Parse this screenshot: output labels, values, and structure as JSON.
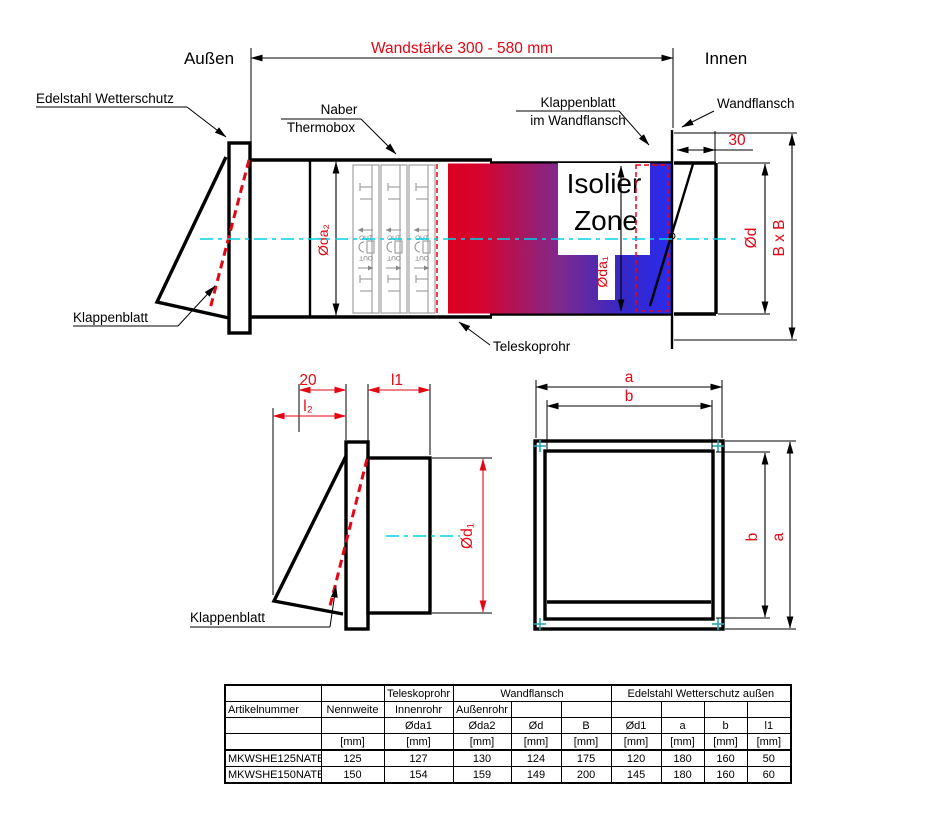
{
  "colors": {
    "red": "#e30613",
    "cyan": "#00d3e6",
    "teal": "#2aa7b2",
    "line": "#000000",
    "gray": "#999999",
    "grad_red": "#dc0021",
    "grad_purple": "#7e2a8d",
    "grad_blue": "#2a2aef"
  },
  "header": {
    "aussen": "Außen",
    "innen": "Innen",
    "wandstaerke": "Wandstärke 300 - 580 mm"
  },
  "main_view": {
    "edelstahl_label": "Edelstahl Wetterschutz",
    "naber_line1": "Naber",
    "naber_line2": "Thermobox",
    "klappen_wf_line1": "Klappenblatt",
    "klappen_wf_line2": "im Wandflansch",
    "wandflansch_label": "Wandflansch",
    "dim_30": "30",
    "klappenblatt_label": "Klappenblatt",
    "teleskoprohr_label": "Teleskoprohr",
    "isolier_line1": "Isolier",
    "isolier_line2": "Zone",
    "dim_oda2": "Øda₂",
    "dim_oda1": "Øda₁",
    "dim_od": "Ød",
    "dim_bxb": "B x B",
    "out_label": "OUT"
  },
  "side_view": {
    "dim_20": "20",
    "dim_l1": "l1",
    "dim_l2": "l₂",
    "dim_od1": "Ød₁",
    "klappenblatt_label": "Klappenblatt"
  },
  "front_view": {
    "dim_a": "a",
    "dim_b": "b",
    "dim_b_right": "b",
    "dim_a_right": "a"
  },
  "table": {
    "group_teleskoprohr": "Teleskoprohr",
    "group_wandflansch": "Wandflansch",
    "group_edelstahl": "Edelstahl Wetterschutz außen",
    "artikelnummer": "Artikelnummer",
    "nennweite": "Nennweite",
    "innenrohr": "Innenrohr",
    "aussenrohr": "Außenrohr",
    "dim_headers": [
      "Øda1",
      "Øda2",
      "Ød",
      "B",
      "Ød1",
      "a",
      "b",
      "l1"
    ],
    "unit": "[mm]",
    "rows": [
      {
        "artikel": "MKWSHE125NATB",
        "values": [
          "125",
          "127",
          "130",
          "124",
          "175",
          "120",
          "180",
          "160",
          "50"
        ]
      },
      {
        "artikel": "MKWSHE150NATB",
        "values": [
          "150",
          "154",
          "159",
          "149",
          "200",
          "145",
          "180",
          "160",
          "60"
        ]
      }
    ]
  }
}
